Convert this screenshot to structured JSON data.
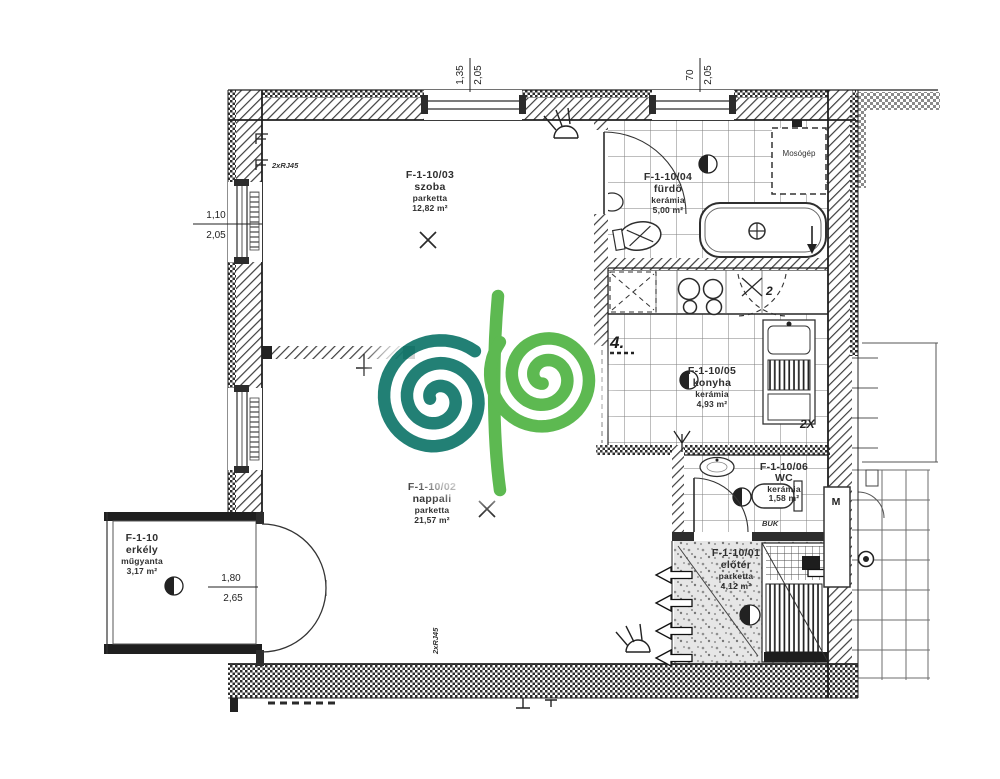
{
  "colors": {
    "ink": "#2f2f2f",
    "teal": "#177a6e",
    "green": "#55b648"
  },
  "rooms": {
    "szoba": {
      "code": "F-1-10/03",
      "name": "szoba",
      "floor": "parketta",
      "area": "12,82 m²"
    },
    "nappali": {
      "code": "F-1-10/02",
      "name": "nappali",
      "floor": "parketta",
      "area": "21,57 m²"
    },
    "furdo": {
      "code": "F-1-10/04",
      "name": "fürdő",
      "floor": "kerámia",
      "area": "5,00 m²"
    },
    "konyha": {
      "code": "F-1-10/05",
      "name": "konyha",
      "floor": "kerámia",
      "area": "4,93 m²"
    },
    "wc": {
      "code": "F-1-10/06",
      "name": "WC",
      "floor": "kerámia",
      "area": "1,58 m²"
    },
    "eloter": {
      "code": "F-1-10/01",
      "name": "előtér",
      "floor": "parketta",
      "area": "4,12 m²"
    },
    "erkely": {
      "code": "F-1-10",
      "name": "erkély",
      "floor": "műgyanta",
      "area": "3,17 m²"
    }
  },
  "dimensions": {
    "szoba_window": {
      "width": "1,35",
      "height": "2,05"
    },
    "furdo_window": {
      "width": "70",
      "height": "2,05"
    },
    "left_window": {
      "width": "1,10",
      "height": "2,05"
    },
    "balcony_door": {
      "width": "1,80",
      "height": "2,65"
    }
  },
  "annotations": {
    "washing_machine": "Mosógép",
    "elevator": "M",
    "data_socket": "2xRJ45",
    "kitchen_mark": "4.",
    "cabinet_mark": "2",
    "socket_mark": "2X",
    "window_mark": "BUK"
  }
}
